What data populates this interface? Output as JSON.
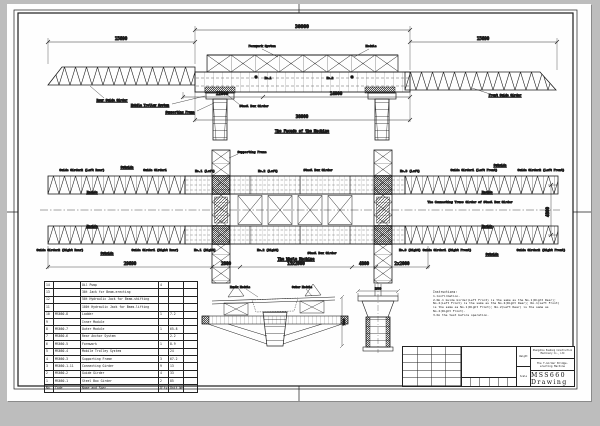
{
  "colors": {
    "background": "#bdbdbd",
    "sheet": "#ffffff",
    "ink": "#1c1c1c"
  },
  "elevation": {
    "title": "The Facade of the Machine",
    "dim_left": "15690",
    "dim_top": "38000",
    "dim_right": "15690",
    "dim_trolley": "12000",
    "dim_mid": "14000",
    "dim_bottom": "38000",
    "labels": {
      "formwork_system": "Formwork System",
      "module": "Module",
      "rear_guide_girder": "Rear Guide Girder",
      "mobile_trolley_system": "Mobile Trolley System",
      "supporting_frame": "Supporting Frame",
      "steel_box_girder": "Steel Box Girder",
      "front_guide_girder": "Front Guide Girder",
      "no1": "No.1",
      "no2": "No.2"
    }
  },
  "plan": {
    "title": "The Whole Machine",
    "labels": {
      "guide_girder2_left_rear": "Guide Girder2 (Left Rear)",
      "guide_girder1": "Guide Girder1",
      "outside": "Outside",
      "inside": "Inside",
      "supporting_frame": "Supporting Frame",
      "no1_left": "No.1 (Left)",
      "no2_left": "No.2 (Left)",
      "no3_left": "No.3 (Left)",
      "steel_box_girder": "Steel Box Girder",
      "guide_girder1_left_front": "Guide Girder1 (Left Front)",
      "guide_girder2_left_front": "Guide Girder2 (Left Front)",
      "connecting_truss": "The Connecting Truss Girder of Steel Box Girder",
      "guide_girder2_right_rear": "Guide Girder2 (Right Rear)",
      "guide_girder1_right_rear": "Guide Girder1 (Right Rear)",
      "no1_right": "No.1 (Right)",
      "no2_right": "No.2 (Right)",
      "no3_right": "No.3 (Right)",
      "guide_girder1_right_front": "Guide Girder1 (Right Front)",
      "guide_girder2_right_front": "Guide Girder2 (Right Front)"
    },
    "dims": {
      "rear": "29690",
      "d1": "2800",
      "d2": "15x2000",
      "d3": "4800",
      "d4": "2x2000",
      "width": "4800"
    }
  },
  "sections": {
    "labels": {
      "inner_module": "Inner Module",
      "outer_module": "Outer Module"
    },
    "dims": {
      "height": "7500",
      "top": "1800"
    }
  },
  "parts_table": {
    "headers": {
      "no": "No.",
      "code": "Code",
      "name": "Name and Spec.",
      "qty": "Q'ty",
      "wt": "Unit Weight",
      "rem": ""
    },
    "rows": [
      {
        "no": "14",
        "code": "",
        "name": "Oil Pump",
        "qty": "4",
        "wt": "",
        "rem": ""
      },
      {
        "no": "13",
        "code": "",
        "name": "30t Jack for Beam-erecting",
        "qty": "",
        "wt": "",
        "rem": ""
      },
      {
        "no": "12",
        "code": "",
        "name": "50t Hydraulic Jack for Beam-shifting",
        "qty": "",
        "wt": "",
        "rem": ""
      },
      {
        "no": "11",
        "code": "",
        "name": "100t Hydraulic Jack for Beam-lifting",
        "qty": "",
        "wt": "",
        "rem": ""
      },
      {
        "no": "10",
        "code": "MS660-8",
        "name": "Ladder",
        "qty": "1",
        "wt": "7.2",
        "rem": ""
      },
      {
        "no": "9",
        "code": "",
        "name": "Inner Module",
        "qty": "",
        "wt": "",
        "rem": ""
      },
      {
        "no": "8",
        "code": "MS660-7",
        "name": "Outer Module",
        "qty": "1",
        "wt": "65.8",
        "rem": ""
      },
      {
        "no": "7",
        "code": "MS660-6",
        "name": "Rear Anchor System",
        "qty": "",
        "wt": "2.2",
        "rem": ""
      },
      {
        "no": "6",
        "code": "MS660-5",
        "name": "Formwork",
        "qty": "1",
        "wt": "8.9",
        "rem": ""
      },
      {
        "no": "5",
        "code": "MS660-4",
        "name": "Mobile Trolley System",
        "qty": "",
        "wt": "24",
        "rem": ""
      },
      {
        "no": "4",
        "code": "MS660-3",
        "name": "Supporting Frame",
        "qty": "3",
        "wt": "67.2",
        "rem": ""
      },
      {
        "no": "3",
        "code": "MS660-1-11",
        "name": "Connecting Girder",
        "qty": "9",
        "wt": "13",
        "rem": ""
      },
      {
        "no": "2",
        "code": "MS660-2",
        "name": "Guide Girder",
        "qty": "4",
        "wt": "33",
        "rem": ""
      },
      {
        "no": "1",
        "code": "MS660-1",
        "name": "Steel Box Girder",
        "qty": "2",
        "wt": "85",
        "rem": ""
      }
    ]
  },
  "notes": {
    "title": "Instructions:",
    "lines": [
      "1.Confirmation.",
      "2.No.1 Guide Girder(Left Front) is the same as the No.1(Right Rear); No.2(Left Front) is the same as the No.2(Right Rear); No.1(Left Front) is the same as No.1(Right Front); No.2(Left Rear) is the same as No.2(Right Front).",
      "3.Do the test before operation."
    ]
  },
  "title_block": {
    "company": "Zhengzhou Huadong Construction Machinery Co., Ltd",
    "product": "The T-Girder Bridge-erecting Machine",
    "drawing_no": "MSS660 Drawing",
    "weight_label": "Weight",
    "scale_label": "Scale"
  }
}
